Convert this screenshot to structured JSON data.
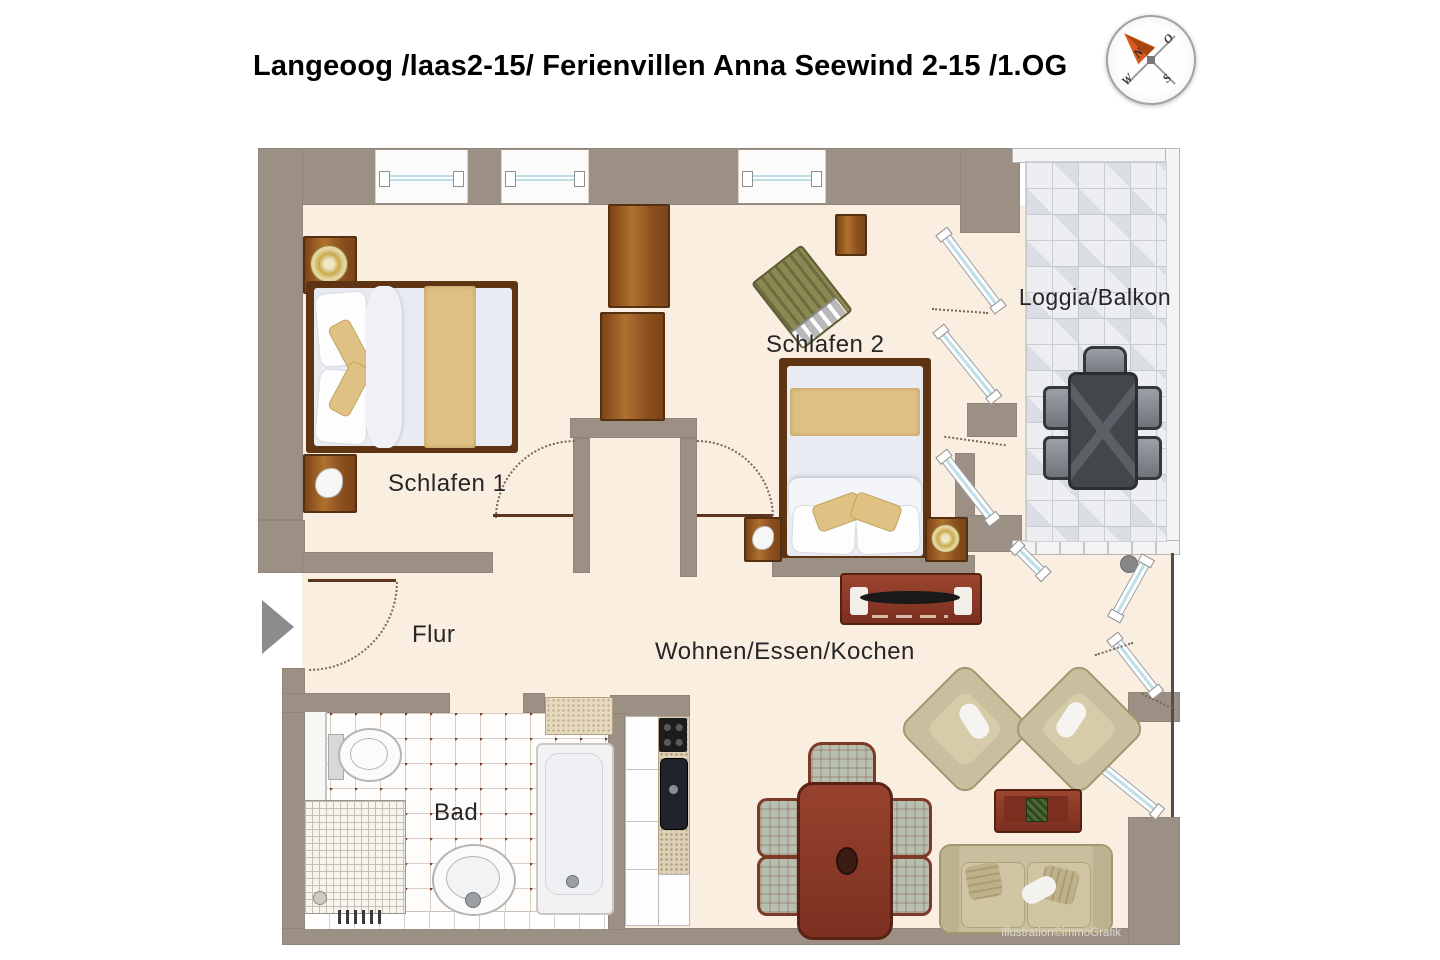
{
  "title": "Langeoog /laas2-15/ Ferienvillen Anna Seewind 2-15 /1.OG",
  "credit": "Illustration©immoGrafik",
  "compass": {
    "n": "N",
    "o": "O",
    "s": "S",
    "w": "W"
  },
  "rooms": {
    "schlafen1": "Schlafen 1",
    "schlafen2": "Schlafen 2",
    "loggia": "Loggia/Balkon",
    "flur": "Flur",
    "wohnen": "Wohnen/Essen/Kochen",
    "bad": "Bad"
  },
  "colors": {
    "wall": "#9c9084",
    "floor": "#faeee1",
    "wood_dark": "#5e3413",
    "blanket": "#dfc183",
    "furniture_red": "#8e3b2a",
    "sofa_beige": "#c9be9d",
    "loggia_tile": "#eceef1",
    "glass": "#bfdfe8",
    "bad_dot": "#7d3b2d",
    "arrow_orange": "#d85a20"
  }
}
